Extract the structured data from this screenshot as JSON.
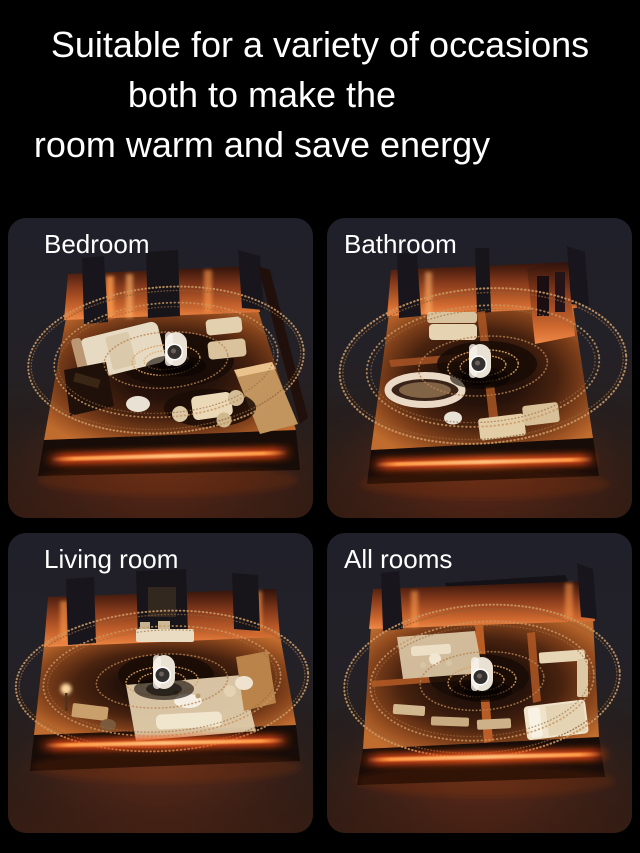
{
  "title": {
    "lines": [
      "Suitable for a variety of occasions",
      "both to make the",
      "room warm and save energy"
    ]
  },
  "panels": [
    {
      "label": "Bedroom"
    },
    {
      "label": "Bathroom"
    },
    {
      "label": "Living room"
    },
    {
      "label": "All rooms"
    }
  ],
  "colors": {
    "background": "#000000",
    "panel_background": "#232128",
    "title_text": "#ffffff",
    "heat_glow_strip": "#ff7a28",
    "heat_ring_dots": "#c89763",
    "lit_wall_orange": "#d06a30",
    "furniture_cream": "#e7dac3",
    "heater_device_white": "#ece4d8"
  }
}
